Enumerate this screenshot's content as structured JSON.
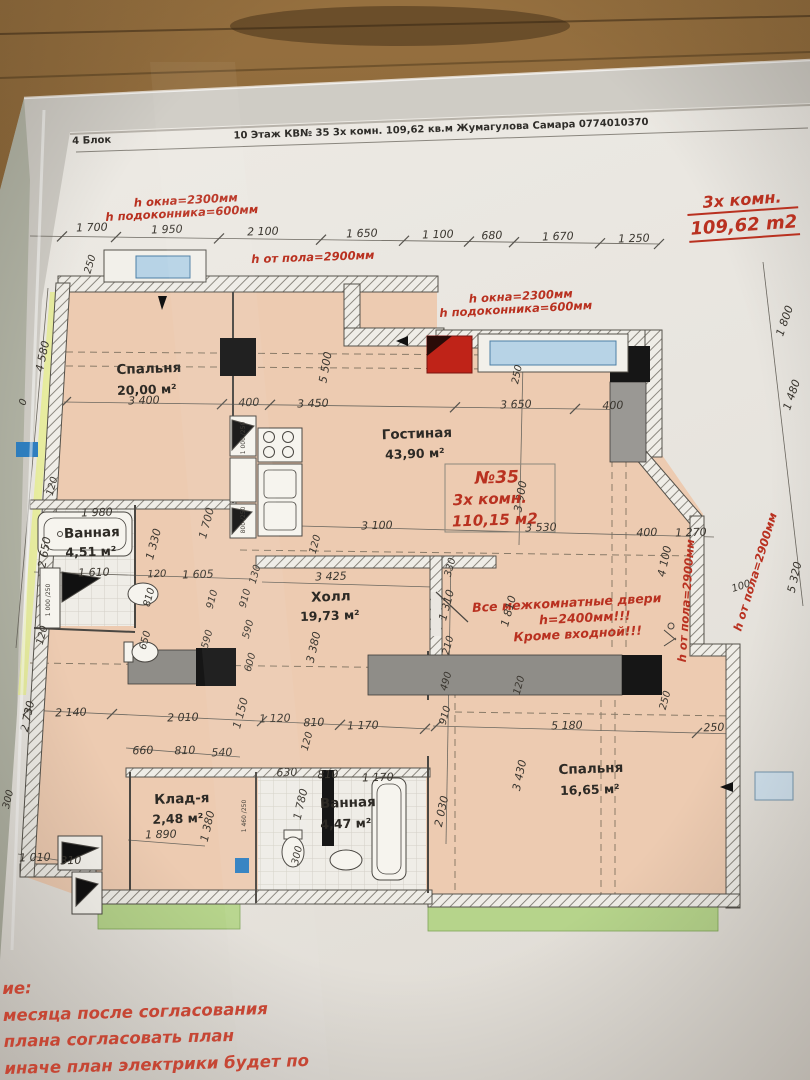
{
  "header": {
    "block": "4 Блок",
    "title": "10 Этаж КВ№ 35 3х комн. 109,62 кв.м Жумагулова Самара 0774010370"
  },
  "title_block": {
    "rooms": "3х комн.",
    "area": "109,62 m2"
  },
  "notes": [
    "ие:",
    "месяца после согласования",
    "плана согласовать план",
    "иначе план электрики будет по",
    "ану."
  ],
  "colors": {
    "paper": "#e9e6e0",
    "room": "#edcbb1",
    "green": "#b6d48b",
    "wall": "#4a4742",
    "red": "#b93120",
    "blue": "#b7d3e6",
    "column": "#161616"
  },
  "rooms": [
    {
      "name": "Спальня",
      "area": "20,00 м²"
    },
    {
      "name": "Гостиная",
      "area": "43,90 м²"
    },
    {
      "name": "Ванная",
      "area": "4,51 м²"
    },
    {
      "name": "Холл",
      "area": "19,73 м²"
    },
    {
      "name": "Клад-я",
      "area": "2,48 м²"
    },
    {
      "name": "Ванная",
      "area": "4,47 м²"
    },
    {
      "name": "Спальня",
      "area": "16,65 м²"
    }
  ],
  "apartment_note": [
    "№35",
    "3х комн.",
    "110,15 м2"
  ],
  "doors_note": [
    "Все межкомнатные двери",
    "h=2400мм!!!",
    "Кроме входной!!!"
  ],
  "labels": [
    {
      "t": "1 700",
      "x": 92,
      "y": 231
    },
    {
      "t": "1 950",
      "x": 167,
      "y": 233
    },
    {
      "t": "2 100",
      "x": 263,
      "y": 235
    },
    {
      "t": "1 650",
      "x": 362,
      "y": 237
    },
    {
      "t": "1 100",
      "x": 438,
      "y": 238
    },
    {
      "t": "680",
      "x": 492,
      "y": 239
    },
    {
      "t": "1 670",
      "x": 558,
      "y": 240
    },
    {
      "t": "1 250",
      "x": 634,
      "y": 242
    },
    {
      "t": "h окна=2300мм",
      "x": 186,
      "y": 204,
      "r": -3,
      "c": "r"
    },
    {
      "t": "h подоконника=600мм",
      "x": 182,
      "y": 217,
      "r": -3,
      "c": "r"
    },
    {
      "t": "h от пола=2900мм",
      "x": 313,
      "y": 261,
      "r": -2,
      "c": "r"
    },
    {
      "t": "h окна=2300мм",
      "x": 521,
      "y": 300,
      "r": -3,
      "c": "r"
    },
    {
      "t": "h подоконника=600мм",
      "x": 516,
      "y": 313,
      "r": -3,
      "c": "r"
    },
    {
      "t": "h от пола=2900мм",
      "x": 690,
      "y": 601,
      "r": -86,
      "c": "r"
    },
    {
      "t": "h от пола=2900мм",
      "x": 759,
      "y": 573,
      "r": -73,
      "c": "r"
    },
    {
      "t": "250",
      "x": 93,
      "y": 265,
      "r": -73,
      "s": 10
    },
    {
      "t": "4 580",
      "x": 46,
      "y": 357,
      "r": -78
    },
    {
      "t": "0",
      "x": 26,
      "y": 403,
      "r": -73,
      "s": 10
    },
    {
      "t": "120",
      "x": 55,
      "y": 487,
      "r": -75,
      "s": 10
    },
    {
      "t": "2 650",
      "x": 48,
      "y": 553,
      "r": -80
    },
    {
      "t": "120",
      "x": 45,
      "y": 636,
      "r": -75,
      "s": 10
    },
    {
      "t": "2 730",
      "x": 31,
      "y": 717,
      "r": -78
    },
    {
      "t": "300",
      "x": 11,
      "y": 800,
      "r": -76,
      "s": 10
    },
    {
      "t": "3 400",
      "x": 144,
      "y": 404
    },
    {
      "t": "400",
      "x": 249,
      "y": 406
    },
    {
      "t": "3 450",
      "x": 313,
      "y": 407
    },
    {
      "t": "3 650",
      "x": 516,
      "y": 408
    },
    {
      "t": "400",
      "x": 613,
      "y": 409
    },
    {
      "t": "5 500",
      "x": 329,
      "y": 368,
      "r": -80
    },
    {
      "t": "250",
      "x": 520,
      "y": 375,
      "r": -78,
      "s": 10
    },
    {
      "t": "3 900",
      "x": 524,
      "y": 497,
      "r": -80
    },
    {
      "t": "Спальня",
      "x": 149,
      "y": 373,
      "c": "rm"
    },
    {
      "t": "20,00 м²",
      "x": 147,
      "y": 394,
      "c": "ar"
    },
    {
      "t": "Гостиная",
      "x": 417,
      "y": 438,
      "c": "rm"
    },
    {
      "t": "43,90 м²",
      "x": 415,
      "y": 458,
      "c": "ar"
    },
    {
      "t": "1 980",
      "x": 97,
      "y": 516
    },
    {
      "t": "Ванная",
      "x": 92,
      "y": 537,
      "c": "rm"
    },
    {
      "t": "4,51 м²",
      "x": 91,
      "y": 556,
      "c": "ar"
    },
    {
      "t": "1 610",
      "x": 94,
      "y": 576
    },
    {
      "t": "120",
      "x": 157,
      "y": 577,
      "s": 10
    },
    {
      "t": "1 605",
      "x": 198,
      "y": 578
    },
    {
      "t": "1 330",
      "x": 157,
      "y": 545,
      "r": -75
    },
    {
      "t": "1 700",
      "x": 210,
      "y": 524,
      "r": -75
    },
    {
      "t": "810",
      "x": 152,
      "y": 598,
      "r": -75,
      "s": 10
    },
    {
      "t": "910",
      "x": 215,
      "y": 600,
      "r": -75,
      "s": 10
    },
    {
      "t": "650",
      "x": 148,
      "y": 641,
      "r": -75,
      "s": 10
    },
    {
      "t": "590",
      "x": 210,
      "y": 640,
      "r": -75,
      "s": 10
    },
    {
      "t": "130",
      "x": 258,
      "y": 575,
      "r": -75,
      "s": 10
    },
    {
      "t": "910",
      "x": 248,
      "y": 599,
      "r": -75,
      "s": 10
    },
    {
      "t": "590",
      "x": 251,
      "y": 630,
      "r": -75,
      "s": 10
    },
    {
      "t": "600",
      "x": 253,
      "y": 663,
      "r": -75,
      "s": 10
    },
    {
      "t": "3 100",
      "x": 377,
      "y": 529
    },
    {
      "t": "120",
      "x": 318,
      "y": 545,
      "r": -75,
      "s": 10
    },
    {
      "t": "3 425",
      "x": 331,
      "y": 580
    },
    {
      "t": "Холл",
      "x": 331,
      "y": 601,
      "c": "rm"
    },
    {
      "t": "19,73 м²",
      "x": 330,
      "y": 620,
      "c": "ar"
    },
    {
      "t": "3 380",
      "x": 317,
      "y": 648,
      "r": -77
    },
    {
      "t": "№35",
      "x": 497,
      "y": 483,
      "r": -2,
      "s": 17,
      "c": "r"
    },
    {
      "t": "3х комн.",
      "x": 490,
      "y": 504,
      "r": -2,
      "s": 15,
      "c": "r"
    },
    {
      "t": "110,15 м2",
      "x": 495,
      "y": 525,
      "r": -2,
      "s": 15,
      "c": "r"
    },
    {
      "t": "3 530",
      "x": 541,
      "y": 531
    },
    {
      "t": "400",
      "x": 647,
      "y": 536
    },
    {
      "t": "1 270",
      "x": 691,
      "y": 536
    },
    {
      "t": "4 100",
      "x": 668,
      "y": 562,
      "r": -78
    },
    {
      "t": "100",
      "x": 742,
      "y": 589,
      "r": -18,
      "s": 10
    },
    {
      "t": "5 320",
      "x": 798,
      "y": 578,
      "r": -77
    },
    {
      "t": "1 800",
      "x": 788,
      "y": 322,
      "r": -71
    },
    {
      "t": "1 480",
      "x": 795,
      "y": 396,
      "r": -71
    },
    {
      "t": "Все межкомнатные двери",
      "x": 567,
      "y": 607,
      "r": -3,
      "s": 12.5,
      "c": "r"
    },
    {
      "t": "h=2400мм!!!",
      "x": 585,
      "y": 622,
      "r": -3,
      "s": 12.5,
      "c": "r"
    },
    {
      "t": "Кроме входной!!!",
      "x": 578,
      "y": 638,
      "r": -3,
      "s": 12.5,
      "c": "r"
    },
    {
      "t": "330",
      "x": 453,
      "y": 568,
      "r": -75,
      "s": 10
    },
    {
      "t": "1 310",
      "x": 450,
      "y": 606,
      "r": -75
    },
    {
      "t": "1 810",
      "x": 512,
      "y": 612,
      "r": -75
    },
    {
      "t": "210",
      "x": 451,
      "y": 646,
      "r": -75,
      "s": 10
    },
    {
      "t": "490",
      "x": 449,
      "y": 682,
      "r": -75,
      "s": 10
    },
    {
      "t": "910",
      "x": 448,
      "y": 716,
      "r": -75,
      "s": 10
    },
    {
      "t": "120",
      "x": 522,
      "y": 686,
      "r": -75,
      "s": 10
    },
    {
      "t": "2 030",
      "x": 445,
      "y": 812,
      "r": -78
    },
    {
      "t": "3 430",
      "x": 523,
      "y": 776,
      "r": -78
    },
    {
      "t": "5 180",
      "x": 567,
      "y": 729
    },
    {
      "t": "250",
      "x": 714,
      "y": 731
    },
    {
      "t": "250",
      "x": 668,
      "y": 701,
      "r": -75,
      "s": 10
    },
    {
      "t": "Спальня",
      "x": 591,
      "y": 773,
      "c": "rm"
    },
    {
      "t": "16,65 м²",
      "x": 590,
      "y": 794,
      "c": "ar"
    },
    {
      "t": "2 140",
      "x": 71,
      "y": 716
    },
    {
      "t": "2 010",
      "x": 183,
      "y": 721
    },
    {
      "t": "1 150",
      "x": 244,
      "y": 714,
      "r": -75
    },
    {
      "t": "1 120",
      "x": 275,
      "y": 722
    },
    {
      "t": "810",
      "x": 314,
      "y": 726
    },
    {
      "t": "1 170",
      "x": 363,
      "y": 729
    },
    {
      "t": "120",
      "x": 310,
      "y": 742,
      "r": -75,
      "s": 10
    },
    {
      "t": "660",
      "x": 143,
      "y": 754
    },
    {
      "t": "810",
      "x": 185,
      "y": 754
    },
    {
      "t": "540",
      "x": 222,
      "y": 756
    },
    {
      "t": "630",
      "x": 287,
      "y": 776
    },
    {
      "t": "810",
      "x": 328,
      "y": 778
    },
    {
      "t": "1 170",
      "x": 378,
      "y": 781
    },
    {
      "t": "Клад-я",
      "x": 182,
      "y": 803,
      "c": "rm"
    },
    {
      "t": "2,48 м²",
      "x": 178,
      "y": 823,
      "c": "ar"
    },
    {
      "t": "1 890",
      "x": 161,
      "y": 838
    },
    {
      "t": "1 380",
      "x": 211,
      "y": 827,
      "r": -77
    },
    {
      "t": "Ванная",
      "x": 348,
      "y": 807,
      "c": "rm"
    },
    {
      "t": "4,47 м²",
      "x": 346,
      "y": 828,
      "c": "ar"
    },
    {
      "t": "1 780",
      "x": 304,
      "y": 805,
      "r": -77
    },
    {
      "t": "300",
      "x": 300,
      "y": 856,
      "r": -77,
      "s": 10
    },
    {
      "t": "1 010",
      "x": 35,
      "y": 861
    },
    {
      "t": "310",
      "x": 71,
      "y": 864
    },
    {
      "t": "1 000 /250",
      "x": 245,
      "y": 438,
      "r": -90,
      "s": 6,
      "c": "sm"
    },
    {
      "t": "800 /250",
      "x": 245,
      "y": 520,
      "r": -90,
      "s": 6,
      "c": "sm"
    },
    {
      "t": "1 000 /250",
      "x": 50,
      "y": 600,
      "r": -90,
      "s": 6,
      "c": "sm"
    },
    {
      "t": "1 460 /250",
      "x": 246,
      "y": 816,
      "r": -90,
      "s": 6,
      "c": "sm"
    }
  ]
}
